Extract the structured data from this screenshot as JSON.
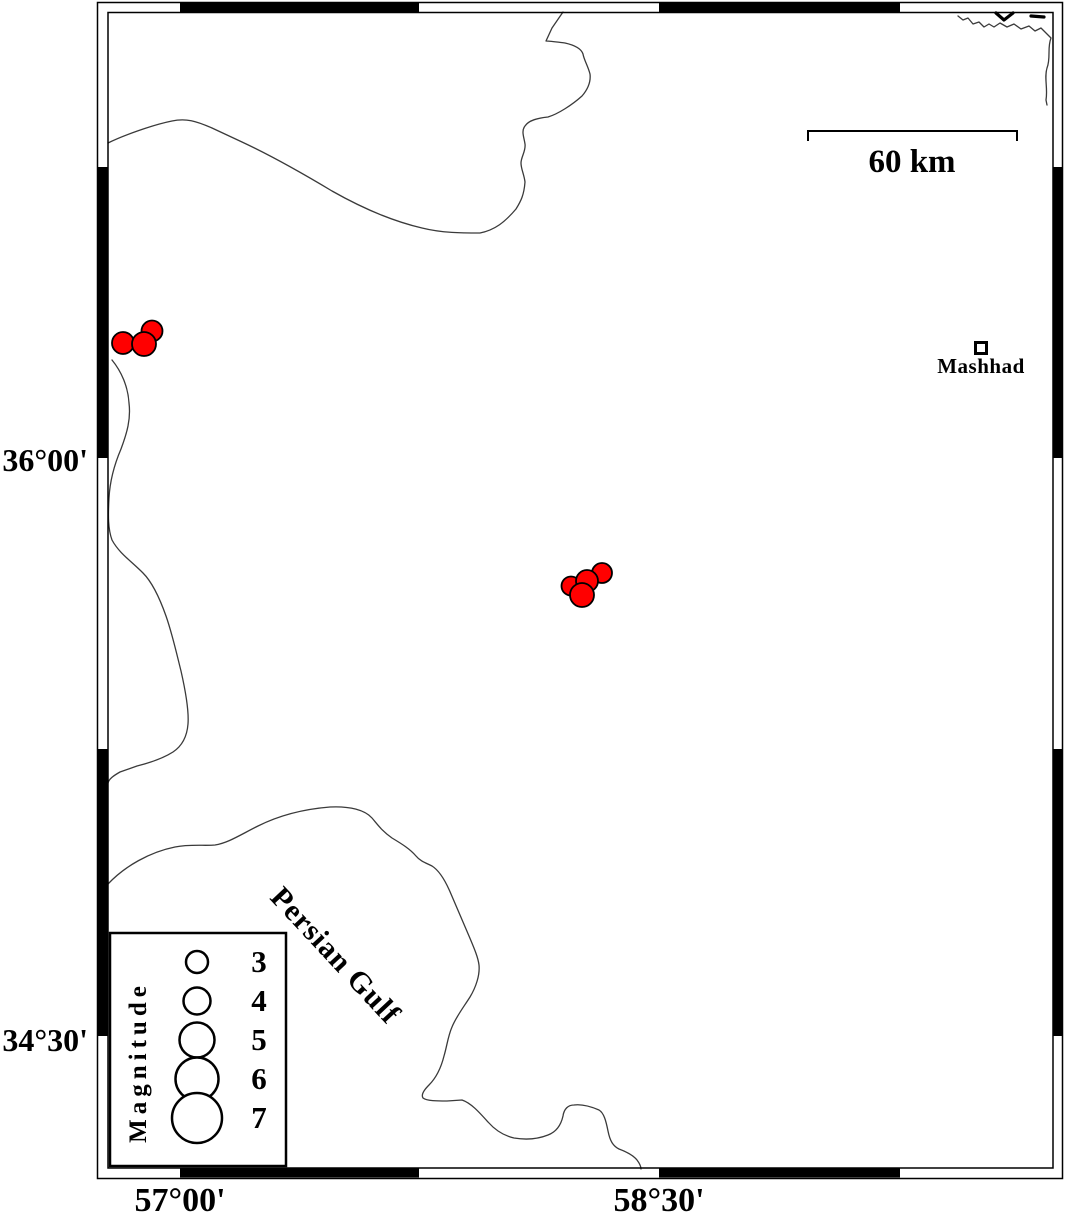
{
  "figure": {
    "type": "earthquake-epicenter-map",
    "background_color": "#ffffff",
    "frame_color": "#000000"
  },
  "axis": {
    "left_labels": [
      {
        "text": "36°00'",
        "y_px": 460
      },
      {
        "text": "34°30'",
        "y_px": 1040
      }
    ],
    "bottom_labels": [
      {
        "text": "57°00'",
        "x_px": 180
      },
      {
        "text": "58°30'",
        "x_px": 659
      }
    ]
  },
  "scale_bar": {
    "label": "60 km"
  },
  "city": {
    "name": "Mashhad",
    "marker": "open-square",
    "x_px": 981,
    "y_px": 348
  },
  "sea_label": {
    "text": "Persian Gulf",
    "x_px": 335,
    "y_px": 956,
    "rotation_deg": 47
  },
  "legend": {
    "title": "Magnitude",
    "entries": [
      {
        "label": "3",
        "y_px": 962,
        "radius_px": 11
      },
      {
        "label": "4",
        "y_px": 1001,
        "radius_px": 13.5
      },
      {
        "label": "5",
        "y_px": 1040,
        "radius_px": 17.5
      },
      {
        "label": "6",
        "y_px": 1079,
        "radius_px": 21.5
      },
      {
        "label": "7",
        "y_px": 1118,
        "radius_px": 25
      }
    ],
    "circle_x_px": 197
  },
  "earthquakes": {
    "fill_color": "#ff0000",
    "outline_color": "#000000",
    "points_px": [
      {
        "x": 152,
        "y": 331,
        "r": 10.5
      },
      {
        "x": 123,
        "y": 343,
        "r": 11
      },
      {
        "x": 144,
        "y": 344,
        "r": 12
      },
      {
        "x": 602,
        "y": 573,
        "r": 10
      },
      {
        "x": 571,
        "y": 586,
        "r": 9.5
      },
      {
        "x": 587,
        "y": 581,
        "r": 11
      },
      {
        "x": 582,
        "y": 595,
        "r": 12
      }
    ]
  }
}
